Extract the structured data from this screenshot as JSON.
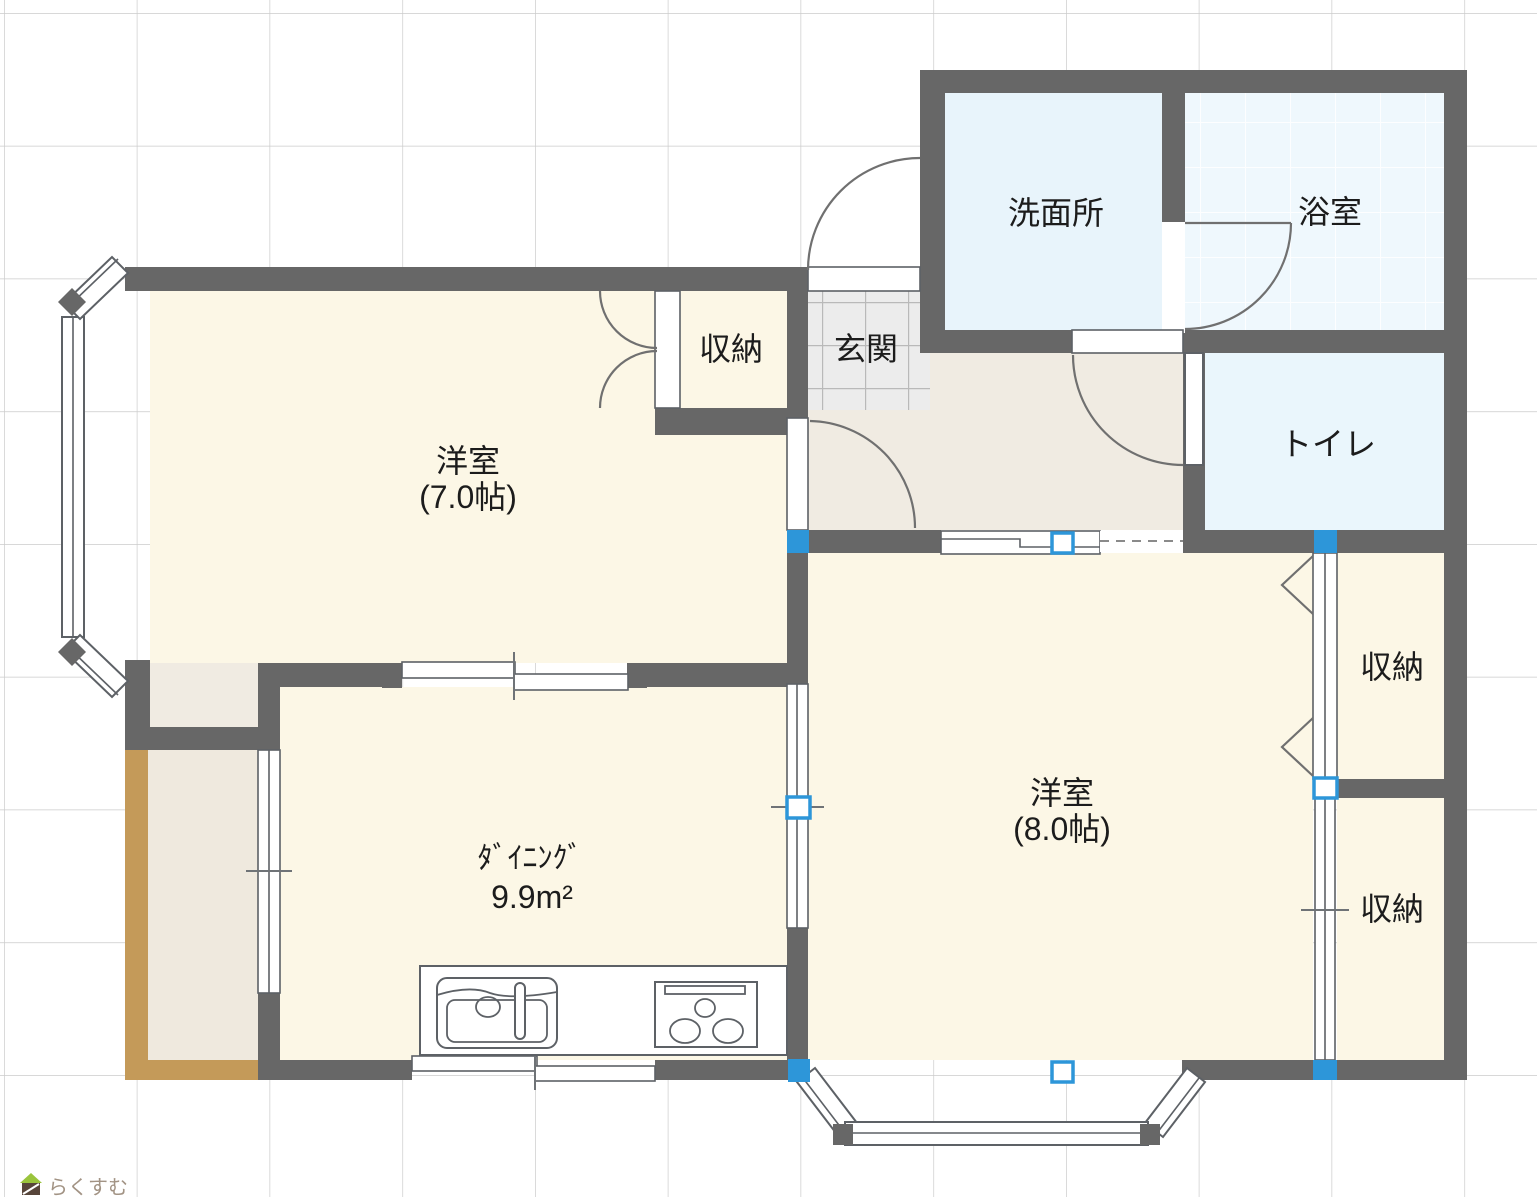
{
  "app": {
    "watermark_text": "らくすむ"
  },
  "labels": {
    "washroom": "洗面所",
    "bath": "浴室",
    "closet_top": "収納",
    "entrance": "玄関",
    "toilet": "トイレ",
    "western7_name": "洋室",
    "western7_size": "(7.0帖)",
    "western8_name": "洋室",
    "western8_size": "(8.0帖)",
    "dining_name": "ﾀﾞｲﾆﾝｸﾞ",
    "dining_size": "9.9m²",
    "closet_right_upper": "収納",
    "closet_right_lower": "収納"
  },
  "colors": {
    "wall": "#676767",
    "room_cream": "#fcf7e6",
    "hall_beige": "#f0ebe2",
    "balcony_beige": "#efe9de",
    "balcony_tan": "#c49a59",
    "washroom_blue": "#e8f4fb",
    "bath_blue": "#eff8fd",
    "toilet_blue": "#eaf6fc",
    "entrance_tile": "#ececec",
    "handle": "#2d96d9",
    "grid": "#cbcbcb"
  }
}
